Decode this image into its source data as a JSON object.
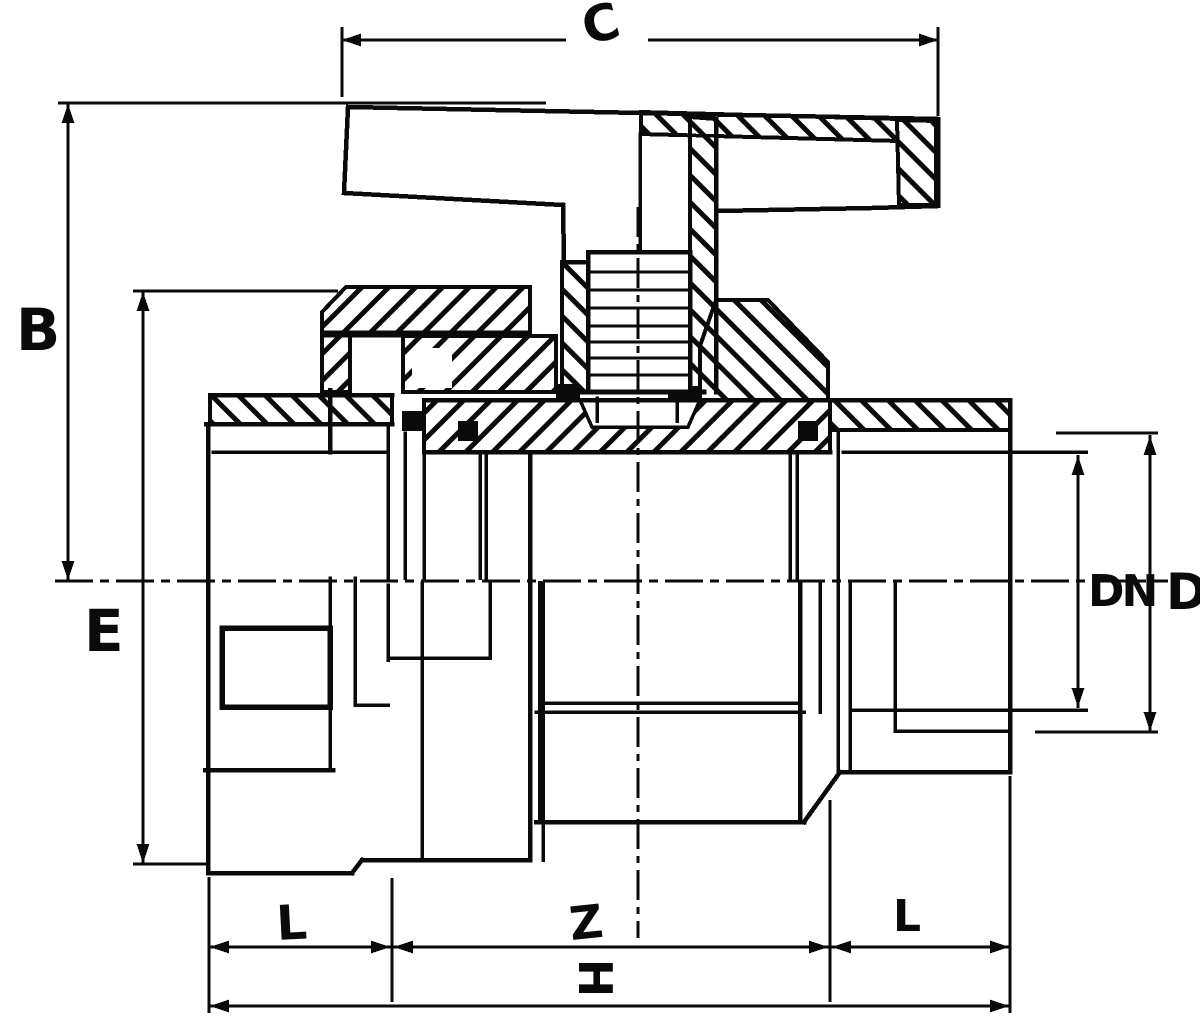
{
  "diagram": {
    "background": "#ffffff",
    "ink": "#0a0a0a",
    "dimension_labels": {
      "c": "C",
      "b": "B",
      "e": "E",
      "dn": "DN",
      "d": "D",
      "l_left": "L",
      "z": "Z",
      "l_right": "L",
      "h": "H"
    }
  }
}
